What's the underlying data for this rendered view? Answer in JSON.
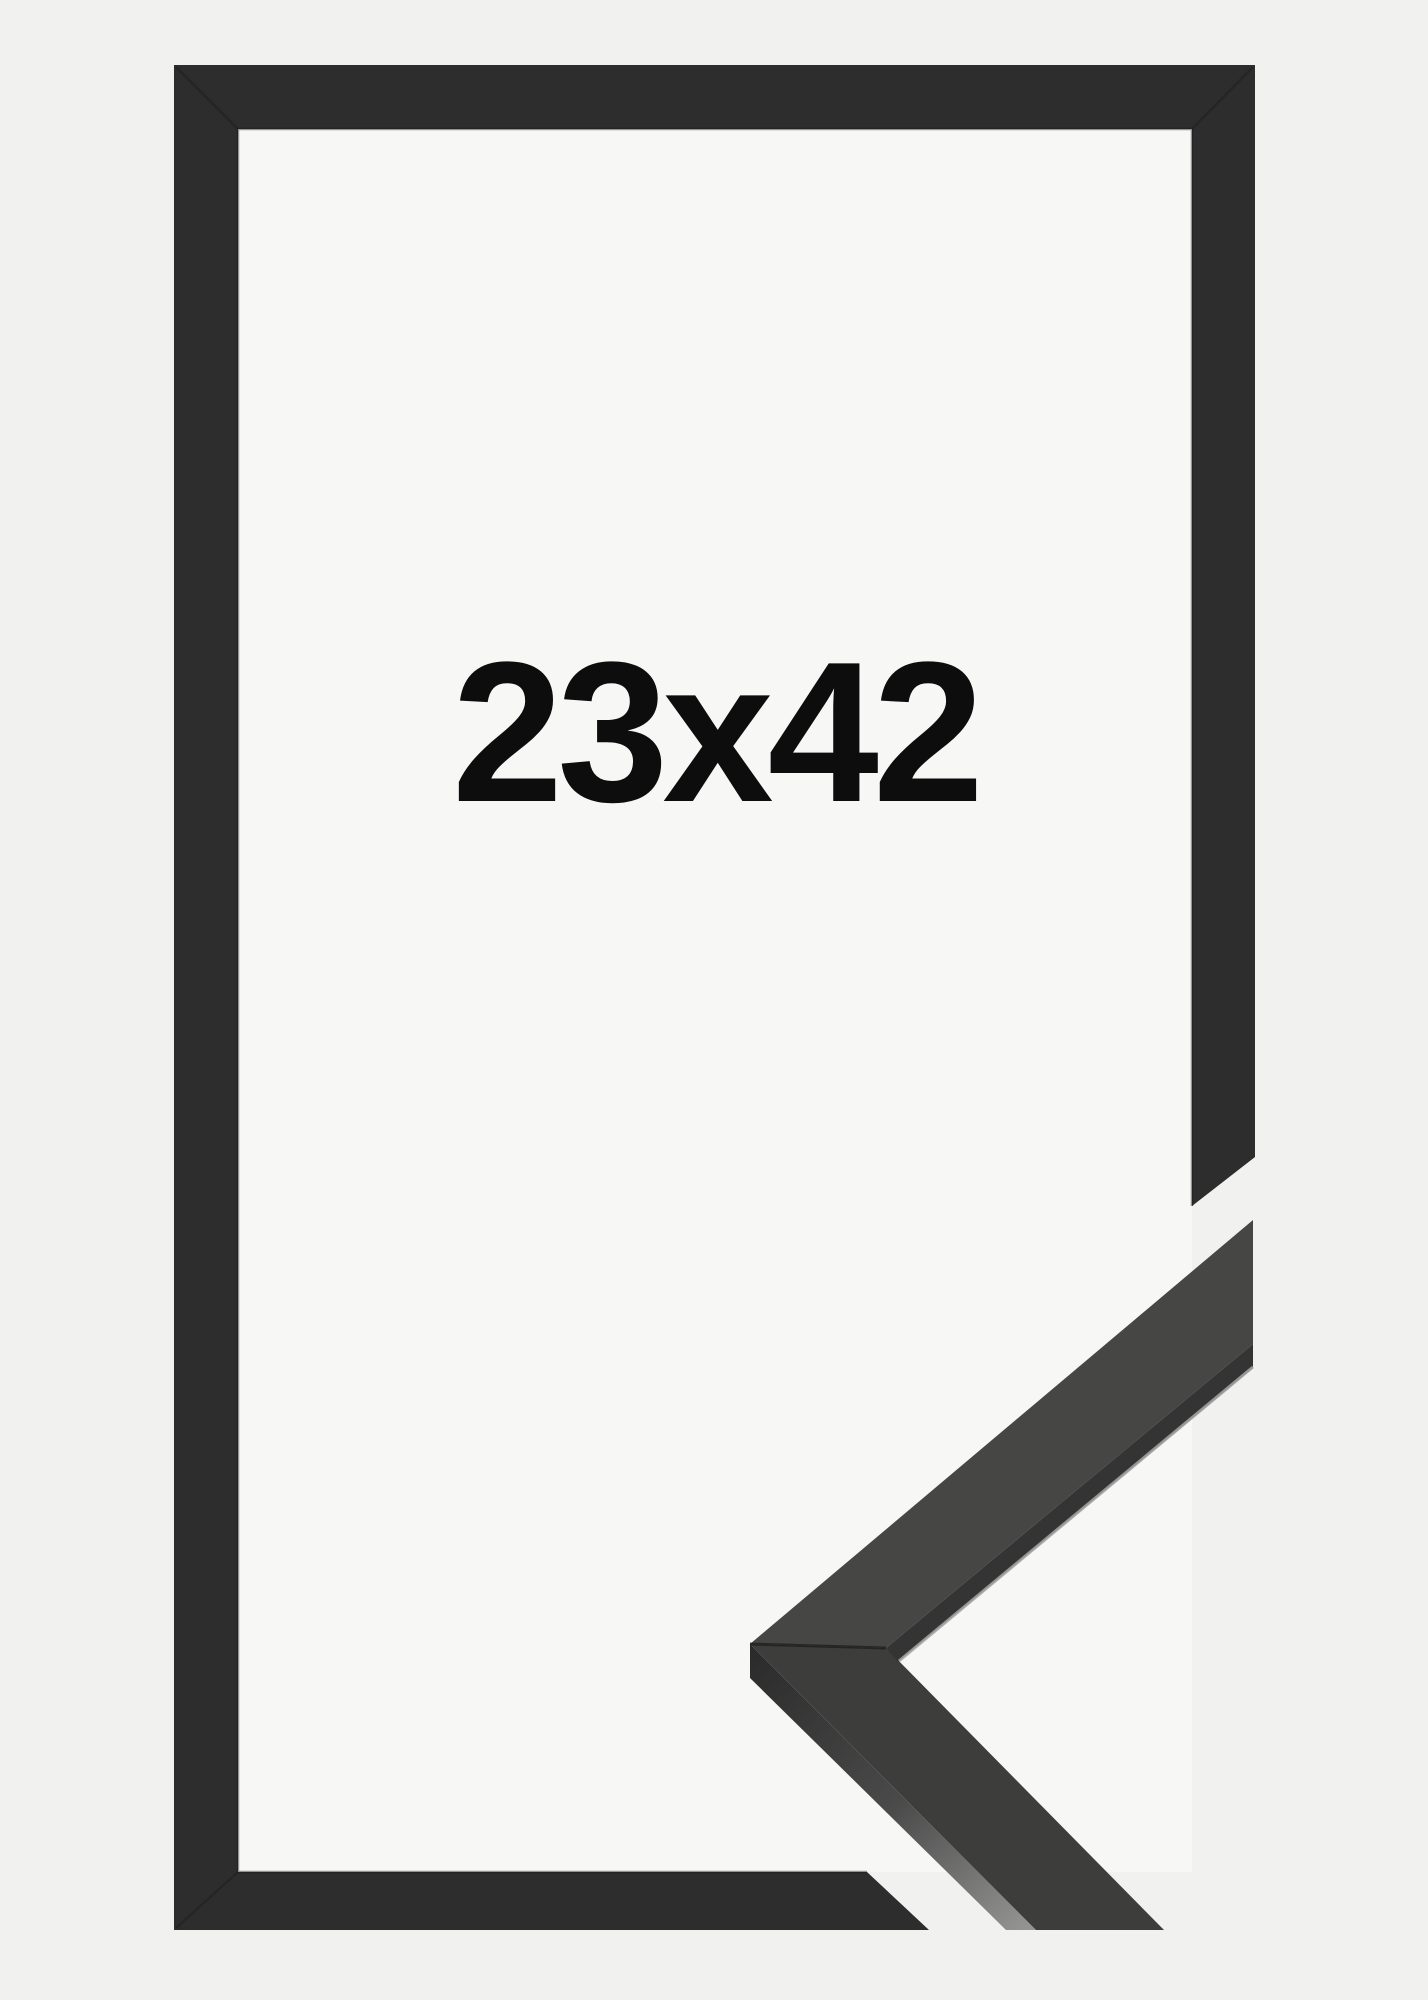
{
  "product": {
    "size_label": "23x42"
  },
  "colors": {
    "page_bg": "#f1f1f0",
    "opening_bg": "#f7f7f6",
    "frame_front": "#2d2d2d",
    "miter_line": "#1f1f1f",
    "inner_edge_shadow": "#1b1b1b",
    "sample_face_upper": "#464645",
    "sample_face_lower": "#3d3d3c",
    "sample_inner_strip": "#343434",
    "sample_side_dark": "#2a2a2a",
    "sample_side_light": "#939392",
    "edge_highlight": "#a8a8a6",
    "label_text": "#0d0d0d"
  }
}
